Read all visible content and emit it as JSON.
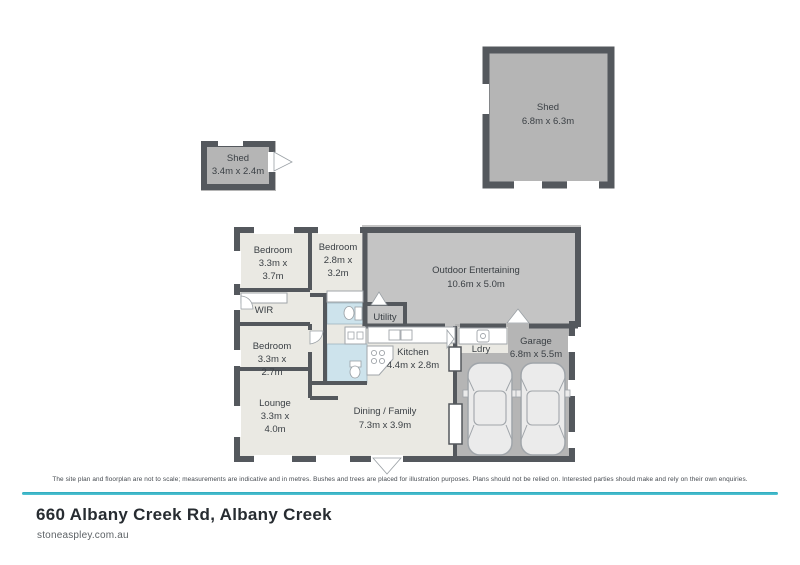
{
  "page": {
    "disclaimer": "The site plan and floorplan are not to scale; measurements are indicative and in metres. Bushes and trees are placed for illustration purposes. Plans should not be relied on. Interested parties should make and rely on their own enquiries.",
    "address": "660 Albany Creek Rd, Albany Creek",
    "website": "stoneaspley.com.au",
    "accent_color": "#3ab7c6"
  },
  "floorplan": {
    "colors": {
      "wall": "#54585d",
      "interior": "#eae9e3",
      "shed_fill": "#b5b5b5",
      "outdoor_fill": "#c4c4c4",
      "garage_fill": "#b5b5b5",
      "bathroom_fill": "#cde3ec"
    },
    "rooms": {
      "shed_large": {
        "label": "Shed",
        "dims": "6.8m x 6.3m"
      },
      "shed_small": {
        "label": "Shed",
        "dims": "3.4m x 2.4m"
      },
      "bedroom1": {
        "label": "Bedroom",
        "dims1": "3.3m x",
        "dims2": "3.7m"
      },
      "bedroom2": {
        "label": "Bedroom",
        "dims1": "2.8m x",
        "dims2": "3.2m"
      },
      "bedroom3": {
        "label": "Bedroom",
        "dims1": "3.3m x",
        "dims2": "2.7m"
      },
      "wir": {
        "label": "WIR"
      },
      "utility": {
        "label": "Utility"
      },
      "outdoor": {
        "label": "Outdoor Entertaining",
        "dims": "10.6m x 5.0m"
      },
      "kitchen": {
        "label": "Kitchen",
        "dims": "4.4m x 2.8m"
      },
      "ldry": {
        "label": "Ldry"
      },
      "garage": {
        "label": "Garage",
        "dims": "6.8m x 5.5m"
      },
      "lounge": {
        "label": "Lounge",
        "dims1": "3.3m x",
        "dims2": "4.0m"
      },
      "dining": {
        "label": "Dining / Family",
        "dims": "7.3m x 3.9m"
      }
    }
  }
}
